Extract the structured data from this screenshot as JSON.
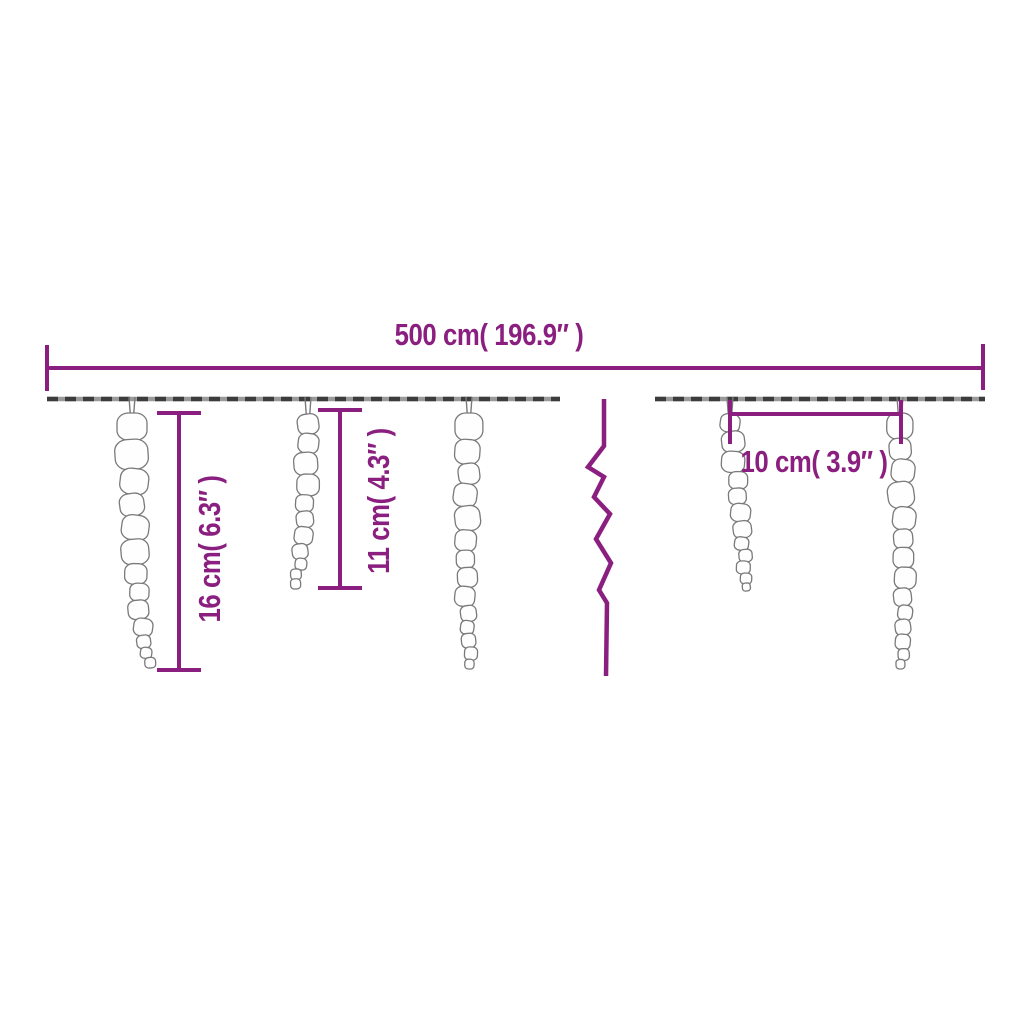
{
  "diagram": {
    "total_length_label": "500 cm( 196.9″ )",
    "left_icicle_label": "16 cm( 6.3″ )",
    "middle_icicle_label": "11 cm( 4.3″ )",
    "spacing_label": "10 cm( 3.9″ )"
  },
  "colors": {
    "accent": "#8a1f80",
    "string_dark": "#3c3c3c",
    "string_light": "#9a9a9a",
    "icicle_outline": "#7a7a7a",
    "icicle_fill": "#fefefe",
    "background": "#ffffff"
  }
}
